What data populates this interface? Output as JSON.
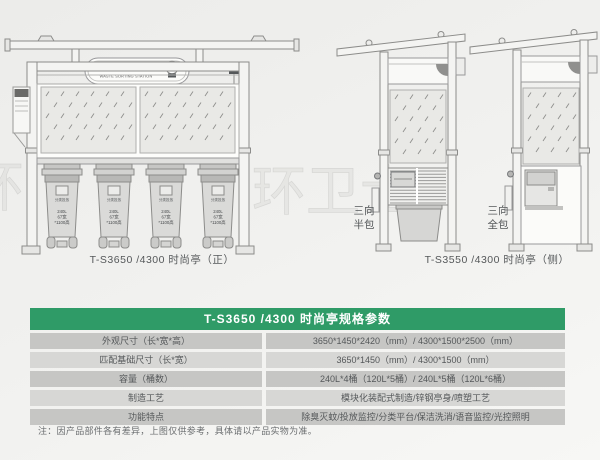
{
  "banner": {
    "title_cn": "共筑美好环境建设小区环保亭",
    "title_en": "WASTE SORTING STATION"
  },
  "front_view": {
    "caption": "T-S3650 /4300 时尚亭（正）",
    "bin_tag": "分类投放",
    "bin_lines": [
      "240L",
      "67宽",
      "*1100高"
    ]
  },
  "side_views": {
    "caption": "T-S3550 /4300 时尚亭（侧）",
    "half_wrap": [
      "三向",
      "半包"
    ],
    "full_wrap": [
      "三向",
      "全包"
    ]
  },
  "watermark": "环卫士",
  "spec_table": {
    "title": "T-S3650 /4300 时尚亭规格参数",
    "header_color": "#2f9b67",
    "row_colors": [
      "#d7d7d5",
      "#c6c6c4"
    ],
    "rows": [
      {
        "label": "外观尺寸（长*宽*高）",
        "value": "3650*1450*2420（mm）/ 4300*1500*2500（mm）"
      },
      {
        "label": "匹配基础尺寸（长*宽）",
        "value": "3650*1450（mm）/ 4300*1500（mm）"
      },
      {
        "label": "容量（桶数）",
        "value": "240L*4桶（120L*5桶）/ 240L*5桶（120L*6桶）"
      },
      {
        "label": "制造工艺",
        "value": "模块化装配式制造/锌钢亭身/喷塑工艺"
      },
      {
        "label": "功能特点",
        "value": "除臭灭蚊/投放监控/分类平台/保洁洗消/语音监控/光控照明"
      }
    ]
  },
  "footnote": "注：因产品部件各有差异，上图仅供参考，具体请以产品实物为准。"
}
